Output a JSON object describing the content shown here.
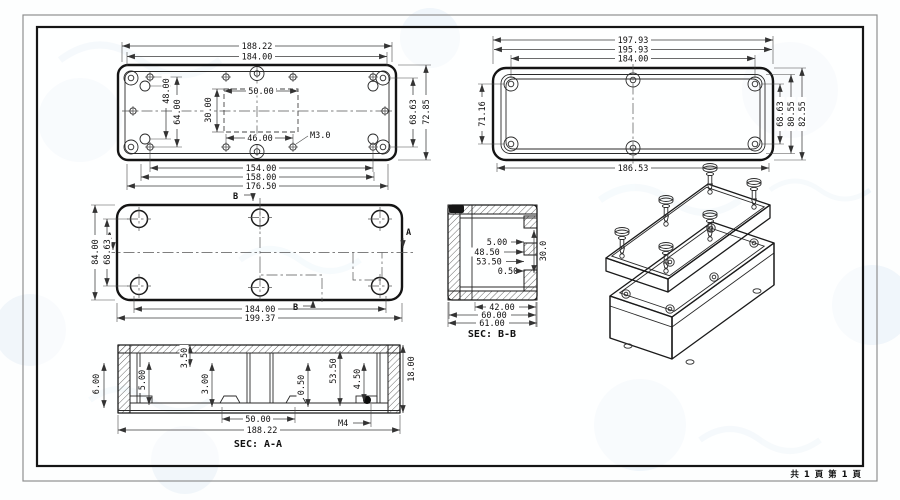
{
  "footer": {
    "page_info": "共 1 頁  第 1 頁"
  },
  "views": {
    "lid_outer": {
      "top_width_outer": "188.22",
      "top_width_inner": "184.00",
      "slot_width": "50.00",
      "slot_height": "30.00",
      "hole_pitch": "46.00",
      "thread_label": "M3.0",
      "left_pitch_outer": "64.00",
      "left_pitch_inner": "48.00",
      "height_outer": "72.85",
      "height_inner": "68.63",
      "bottom_pitch_1": "154.00",
      "bottom_pitch_2": "158.00",
      "bottom_pitch_3": "176.50"
    },
    "lid_inner": {
      "top_width_1": "197.93",
      "top_width_2": "195.93",
      "top_width_3": "184.00",
      "left_height": "71.16",
      "right_height_1": "68.63",
      "right_height_2": "80.55",
      "right_height_3": "82.55",
      "bottom_width": "186.53"
    },
    "base_bottom": {
      "left_height_outer": "84.00",
      "left_height_inner": "68.63",
      "bottom_width_inner": "184.00",
      "bottom_width_outer": "199.37",
      "marker_a": "A",
      "marker_b": "B"
    },
    "sec_bb": {
      "label": "SEC: B-B",
      "dim_1": "5.00",
      "dim_2": "48.50",
      "dim_3": "53.50",
      "dim_4": "0.50",
      "dim_5": "30.0",
      "bottom_1": "42.00",
      "bottom_2": "60.00",
      "bottom_3": "61.00"
    },
    "sec_aa": {
      "label": "SEC: A-A",
      "left_height": "6.00",
      "dim_1": "5.00",
      "dim_2": "3.50",
      "dim_3": "3.00",
      "dim_4": "0.50",
      "dim_5": "53.50",
      "dim_6": "4.50",
      "right_height": "18.00",
      "bottom_1": "50.00",
      "thread_label": "M4",
      "bottom_2": "188.22"
    }
  }
}
